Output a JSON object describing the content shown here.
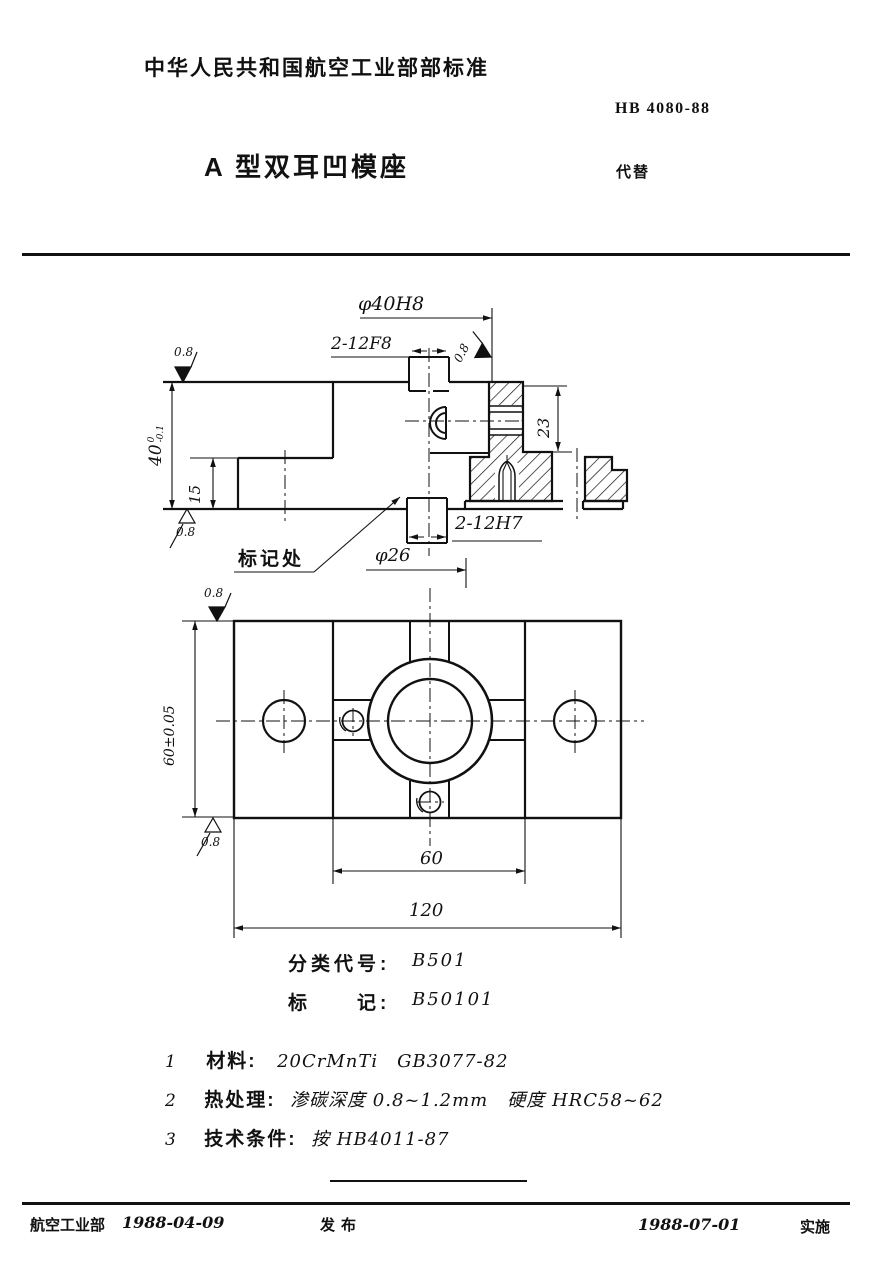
{
  "header": {
    "org_line": "中华人民共和国航空工业部部标准",
    "standard_number": "HB 4080-88",
    "title": "A 型双耳凹模座",
    "replaces_label": "代替"
  },
  "dims": {
    "bore": "φ40H8",
    "slot_top": "2-12F8",
    "h40": "40",
    "h40_up": "0",
    "h40_lo": "-0.1",
    "h15": "15",
    "d23": "23",
    "slot_bot": "2-12H7",
    "c26": "φ26",
    "w60tol": "60±0.05",
    "s60": "60",
    "l120": "120",
    "finish": "0.8",
    "mark_note": "标记处"
  },
  "classification": {
    "class_label": "分类代号:",
    "class_value": "B501",
    "mark_label": "标　　记:",
    "mark_value": "B50101"
  },
  "notes": [
    {
      "num": "1",
      "label": "材料:",
      "text": "20CrMnTi　GB3077-82"
    },
    {
      "num": "2",
      "label": "热处理:",
      "text": "渗碳深度 0.8~1.2mm　硬度 HRC58~62"
    },
    {
      "num": "3",
      "label": "技术条件:",
      "text": "按 HB4011-87"
    }
  ],
  "footer": {
    "issuer": "航空工业部",
    "issue_date": "1988-04-09",
    "issue_label": "发布",
    "impl_date": "1988-07-01",
    "impl_label": "实施"
  }
}
